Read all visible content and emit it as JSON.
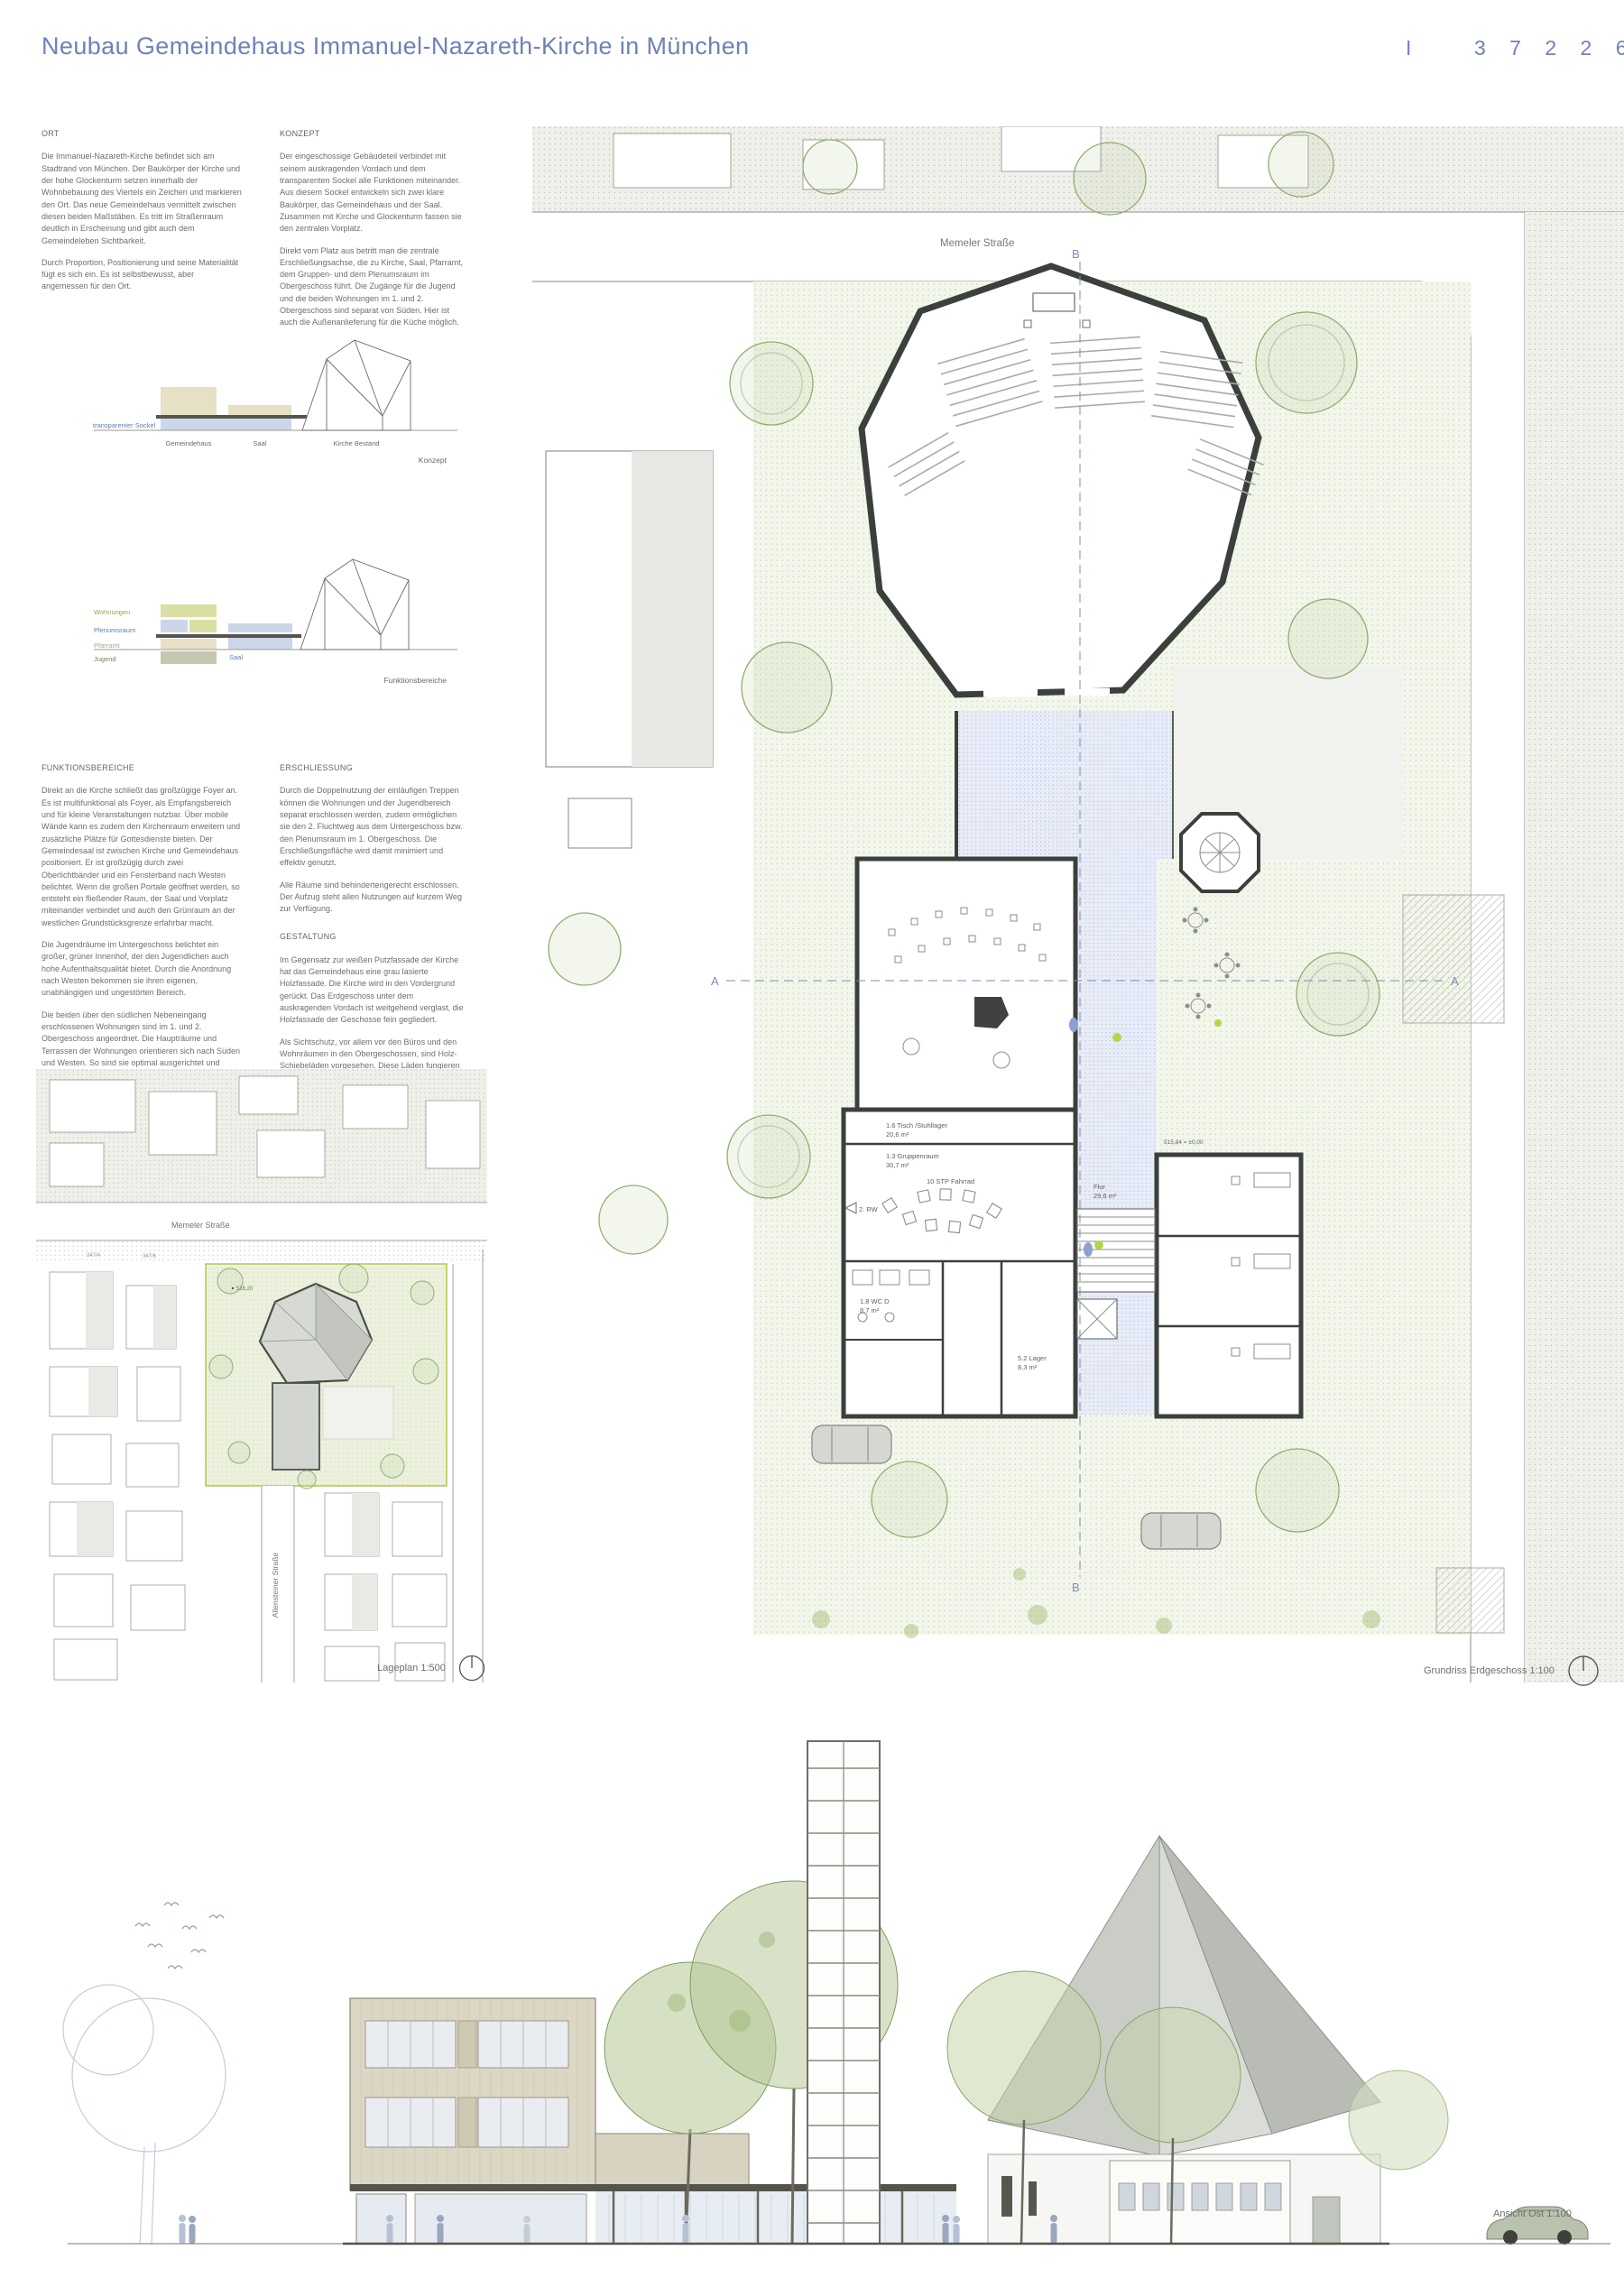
{
  "header": {
    "title": "Neubau Gemeindehaus Immanuel-Nazareth-Kirche in München",
    "mark": "I",
    "entry_number": "3 7 2 2 6 5"
  },
  "sections": {
    "ort": {
      "heading": "ORT",
      "p1": "Die Immanuel-Nazareth-Kirche befindet sich am Stadtrand von München. Der Baukörper der Kirche und der hohe Glockenturm setzen innerhalb der Wohnbebauung des Viertels ein Zeichen und markieren den Ort.  Das neue Gemeindehaus vermittelt zwischen diesen beiden Maßstäben. Es tritt im Straßenraum deutlich in Erscheinung und gibt auch dem Gemeindeleben Sichtbarkeit.",
      "p2": "Durch Proportion, Positionierung und seine Materialität fügt es sich ein. Es ist selbstbewusst, aber angemessen für den Ort."
    },
    "konzept": {
      "heading": "KONZEPT",
      "p1": "Der eingeschossige Gebäudeteil verbindet mit seinem auskragenden Vordach und dem transparenten Sockel alle Funktionen miteinander.  Aus diesem Sockel entwickeln sich zwei klare Baukörper, das Gemeindehaus und der Saal. Zusammen mit Kirche und Glockenturm fassen sie den zentralen Vorplatz.",
      "p2": "Direkt vom Platz aus betritt man die zentrale Erschließungsachse, die zu Kirche, Saal, Pfarramt, dem Gruppen- und dem Plenumsraum im Obergeschoss führt. Die Zugänge für die Jugend und die beiden Wohnungen im 1. und 2. Obergeschoss sind separat von Süden. Hier ist auch die Außenanlieferung für die Küche möglich."
    },
    "funktionsbereiche": {
      "heading": "FUNKTIONSBEREICHE",
      "p1": "Direkt an die Kirche schließt das großzügige Foyer an. Es ist multifunktional als Foyer, als Empfangsbereich und für kleine Veranstaltungen nutzbar. Über mobile Wände kann es zudem den Kirchenraum erweitern und zusätzliche Plätze für Gottesdienste bieten. Der Gemeindesaal ist zwischen Kirche und Gemeindehaus positioniert. Er ist großzügig durch zwei Oberlichtbänder und ein Fensterband nach Westen belichtet. Wenn die großen Portale geöffnet werden, so entsteht ein fließender Raum, der Saal und Vorplatz miteinander verbindet und auch den Grünraum an der westlichen Grundstücksgrenze erfahrbar macht.",
      "p2": "Die Jugendräume im Untergeschoss belichtet ein großer, grüner Innenhof, der den Jugendlichen auch hohe Aufenthaltsqualität bietet. Durch die Anordnung nach Westen bekommen sie ihren eigenen, unabhängigen und ungestörten Bereich.",
      "p3": "Die beiden über den südlichen Nebeneingang erschlossenen Wohnungen sind im 1. und 2. Obergeschoss angeordnet. Die Haupträume und Terrassen der Wohnungen orientieren sich nach Süden und Westen. So sind sie optimal ausgerichtet und bieten gleichzeitig größtmögliche Privatheit."
    },
    "erschliessung": {
      "heading": "ERSCHLIESSUNG",
      "p1": "Durch die Doppelnutzung der einläufigen Treppen können die Wohnungen und der Jugendbereich separat erschlossen werden, zudem ermöglichen sie den 2. Fluchtweg aus dem Untergeschoss bzw. den Plenumsraum im 1. Obergeschoss. Die Erschließungsfläche wird damit minimiert und effektiv genutzt.",
      "p2": "Alle Räume sind behindertengerecht erschlossen. Der Aufzug steht allen Nutzungen auf kurzem Weg zur Verfügung."
    },
    "gestaltung": {
      "heading": "GESTALTUNG",
      "p1": "Im Gegensatz zur weißen Putzfassade der Kirche hat das Gemeindehaus eine grau lasierte Holzfassade. Die Kirche wird in den Vordergrund gerückt.  Das Erdgeschoss unter dem auskragenden Vordach ist weitgehend verglast, die Holzfassade der Geschosse fein gegliedert.",
      "p2": "Als Sichtschutz, vor allem vor den Büros und den Wohnräumen in den Obergeschossen, sind Holz-Schiebeläden vorgesehen. Diese Läden fungieren im Erdgeschoss als Wetter-/Einbruchschutz. Alle Fenster haben einen außenliegenden, textilen Sonnenschutz."
    }
  },
  "diagram_konzept": {
    "caption": "Konzept",
    "label_sockel": "transparenter Sockel",
    "label_gemeindehaus": "Gemeindehaus",
    "label_saal": "Saal",
    "label_kirche": "Kirche Bestand"
  },
  "diagram_funktionsbereiche": {
    "caption": "Funktionsbereiche",
    "label_wohnungen": "Wohnungen",
    "label_plenumsraum": "Plenumsraum",
    "label_pfarramt": "Pfarramt",
    "label_jugend": "Jugend",
    "label_saal": "Saal"
  },
  "site_plan": {
    "caption": "Lageplan 1:500",
    "street_north": "Memeler Straße",
    "street_east": "Allensteiner Straße",
    "level_point": "516,20",
    "parcel_1": "347/4",
    "parcel_2": "347/6"
  },
  "floor_plan": {
    "caption": "Grundriss Erdgeschoss 1:100",
    "street_north": "Memeler Straße",
    "street_east": "Allensteinerstraße",
    "section_a": "A",
    "section_b": "B",
    "level_note": "515,84 = ±0,00",
    "rooms": {
      "stuhllager": "1.6 Tisch /Stuhllager",
      "stuhllager_area": "20,6 m²",
      "gruppenraum": "1.3 Gruppenraum",
      "gruppenraum_area": "30,7 m²",
      "fahrrad": "10 STP Fahrrad",
      "lager": "5.2 Lager",
      "lager_area": "8,3 m²",
      "wc": "1.8 WC D",
      "wc_area": "8,7 m²",
      "flur": "Flur",
      "flur_area": "29,6 m²",
      "rettungsweg": "2. RW"
    }
  },
  "elevation": {
    "caption": "Ansicht Ost 1:100"
  },
  "colors": {
    "accent_blue": "#7081b6",
    "diagram_beige": "#e6e0c4",
    "diagram_blue": "#ccd6ea",
    "diagram_olive": "#d9dfa3",
    "site_green": "#f3f6eb"
  }
}
